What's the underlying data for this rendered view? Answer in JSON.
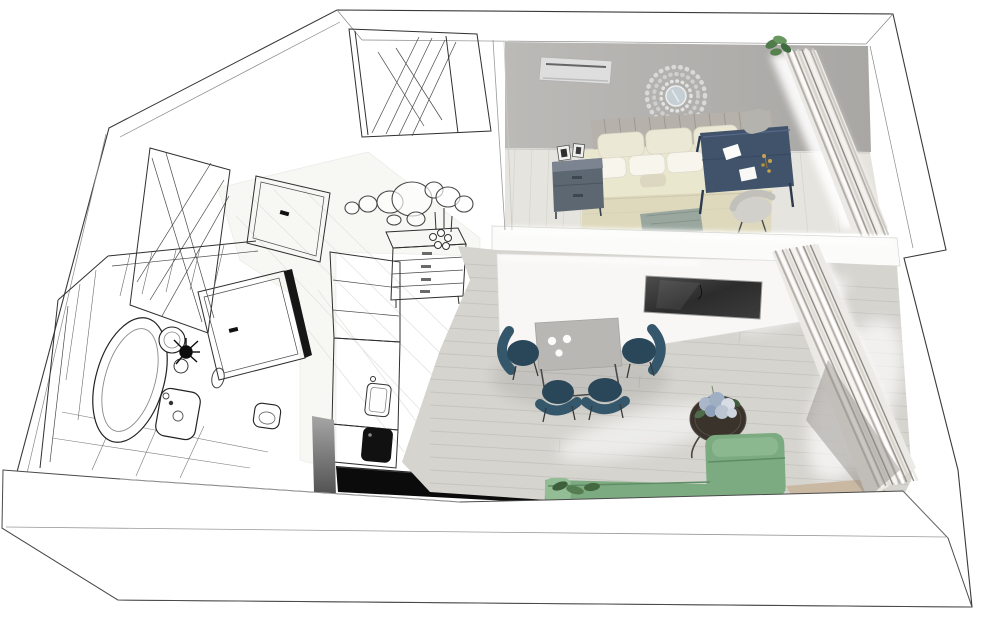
{
  "meta": {
    "title": "Isometric 3D floor plan of a studio apartment",
    "style": "left half black-and-white architectural sketch, right half photorealistic render",
    "canvas": {
      "width": 1000,
      "height": 632
    },
    "view": "axonometric top-down, rotated"
  },
  "colors": {
    "outline": "#2f2f2f",
    "wall_white": "#ffffff",
    "bedroom_wall": "#b3b1ae",
    "bedroom_floor": "#e6e4de",
    "living_floor": "#d6d4cf",
    "plank_line": "#c3c1bb",
    "hall_floor": "#f7f7f4",
    "headboard": "#b6b2ab",
    "bed_linen": "#eae7cf",
    "bed_blanket": "#ded9bd",
    "pillow_cream": "#ece8d6",
    "pillow_white": "#f7f5ec",
    "throw_gray": "#9aa79f",
    "nightstand": "#5d6771",
    "nightstand_top": "#7b8490",
    "desk_navy": "#41536b",
    "desk_leg": "#2c3a50",
    "desk_chair": "#d2d0cb",
    "side_chair_gray": "#b5b3ae",
    "dining_table": "#b9b7b3",
    "chair_teal": "#35576b",
    "chair_teal_dark": "#2a4659",
    "sofa_green": "#7dab81",
    "sofa_green_light": "#93bd95",
    "sofa_green_dark": "#5e8c65",
    "side_table": "#3a332c",
    "flower_blue": "#aab7ca",
    "flower_blue_light": "#d8dde5",
    "leaf_green": "#4e6b4a",
    "plant_green": "#57824f",
    "tv_frame": "#9a9a9a",
    "curtain_base": "#eceae6",
    "curtain_shadow": "#b5b1aa",
    "curtain_dark": "#8e8a84",
    "led_white": "#ffffff",
    "ac_body": "#dedede",
    "cooktop_black": "#111111",
    "island_black": "#0b0b0b",
    "sill_wood": "#c8b59c",
    "mirror_glass": "#c6d0d4"
  },
  "rooms": [
    {
      "id": "entry",
      "name": "Entry hall (sketch)",
      "furniture": [
        "built-in wardrobe",
        "mirrored door panel",
        "interior door with handle",
        "chest of drawers",
        "candlesticks",
        "circle wall mirrors"
      ]
    },
    {
      "id": "bathroom",
      "name": "Bathroom (sketch)",
      "furniture": [
        "oval bathtub",
        "round vessel sink",
        "black plant",
        "washbasin",
        "toilet",
        "wall mirror",
        "door",
        "tiled walls"
      ]
    },
    {
      "id": "kitchen",
      "name": "Kitchenette (sketch)",
      "furniture": [
        "tall cabinets",
        "counter with sink",
        "black cooktop",
        "gray side panel",
        "black base console"
      ]
    },
    {
      "id": "bedroom",
      "name": "Bedroom (render)",
      "furniture": [
        "air conditioner",
        "sunburst mirror",
        "double bed",
        "channel headboard",
        "pillows",
        "nightstand with photo frames",
        "navy desk",
        "papers",
        "desk chair",
        "gray chair",
        "plant",
        "sheer curtains"
      ]
    },
    {
      "id": "living",
      "name": "Living / dining room (render)",
      "furniture": [
        "wall TV",
        "dining table",
        "coffee cups",
        "4 teal chairs",
        "round side table",
        "hydrangea flowers",
        "green sofa",
        "plant",
        "sheer curtains",
        "window sill"
      ]
    }
  ]
}
